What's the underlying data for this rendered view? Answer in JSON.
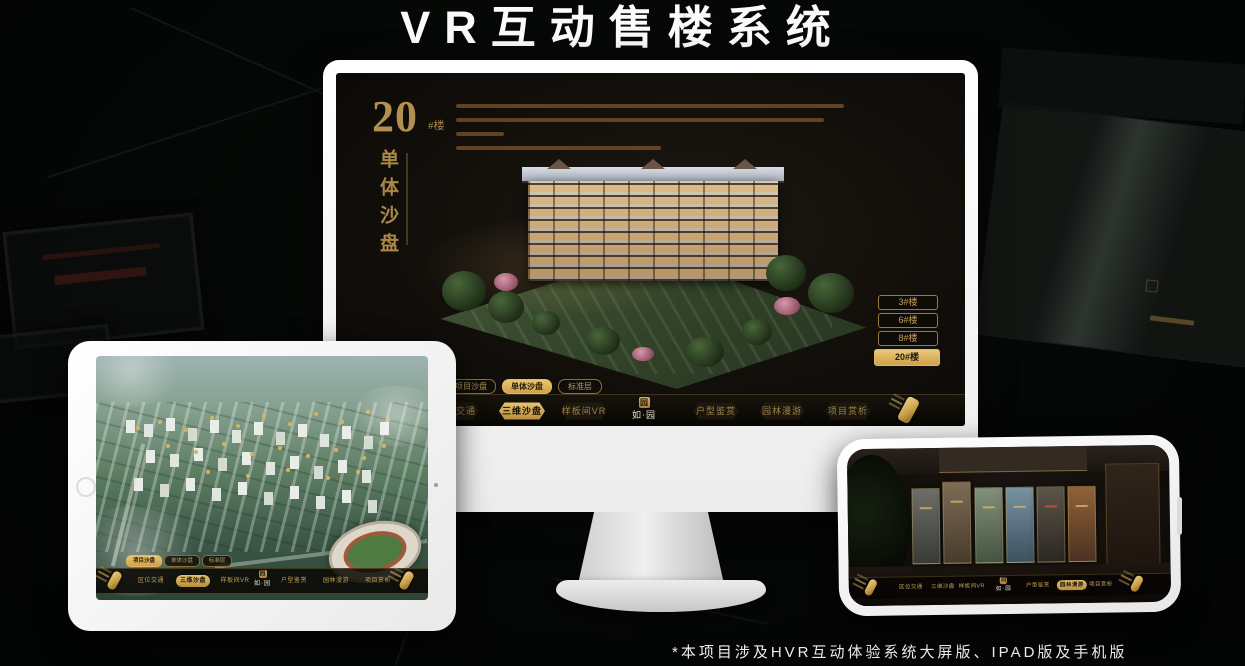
{
  "page": {
    "title": "VR互动售楼系统",
    "footnote": "*本项目涉及HVR互动体验系统大屏版、IPAD版及手机版"
  },
  "brand": {
    "logo_seal": "园",
    "logo_text": "如·园"
  },
  "colors": {
    "gold": "#c9a45c",
    "gold_deep": "#a97f3f",
    "screen_bg": "#14100c",
    "device_frame": "#f2f2f2"
  },
  "monitor": {
    "headline": {
      "number": "20",
      "suffix": "#楼",
      "subtitle_vertical": "单体沙盘"
    },
    "building_buttons": [
      {
        "label": "3#楼",
        "active": false
      },
      {
        "label": "6#楼",
        "active": false
      },
      {
        "label": "8#楼",
        "active": false
      },
      {
        "label": "20#楼",
        "active": true
      }
    ],
    "sub_tabs": [
      {
        "label": "项目沙盘",
        "active": false
      },
      {
        "label": "单体沙盘",
        "active": true
      },
      {
        "label": "标准层",
        "active": false
      }
    ],
    "nav": [
      {
        "label": "区位交通",
        "active": false
      },
      {
        "label": "三维沙盘",
        "active": true
      },
      {
        "label": "样板间VR",
        "active": false
      },
      {
        "label": "户型鉴赏",
        "active": false
      },
      {
        "label": "园林漫游",
        "active": false
      },
      {
        "label": "项目赏析",
        "active": false
      }
    ]
  },
  "ipad": {
    "sub_tabs": [
      {
        "label": "项目沙盘",
        "active": true
      },
      {
        "label": "单体沙盘",
        "active": false
      },
      {
        "label": "标准层",
        "active": false
      }
    ],
    "nav": [
      {
        "label": "区位交通",
        "active": false
      },
      {
        "label": "三维沙盘",
        "active": true
      },
      {
        "label": "样板间VR",
        "active": false
      },
      {
        "label": "户型鉴赏",
        "active": false
      },
      {
        "label": "园林漫游",
        "active": false
      },
      {
        "label": "项目赏析",
        "active": false
      }
    ]
  },
  "phone": {
    "nav": [
      {
        "label": "区位交通",
        "active": false
      },
      {
        "label": "三维沙盘",
        "active": false
      },
      {
        "label": "样板间VR",
        "active": false
      },
      {
        "label": "户型鉴赏",
        "active": false
      },
      {
        "label": "园林漫游",
        "active": true
      },
      {
        "label": "项目赏析",
        "active": false
      }
    ]
  }
}
